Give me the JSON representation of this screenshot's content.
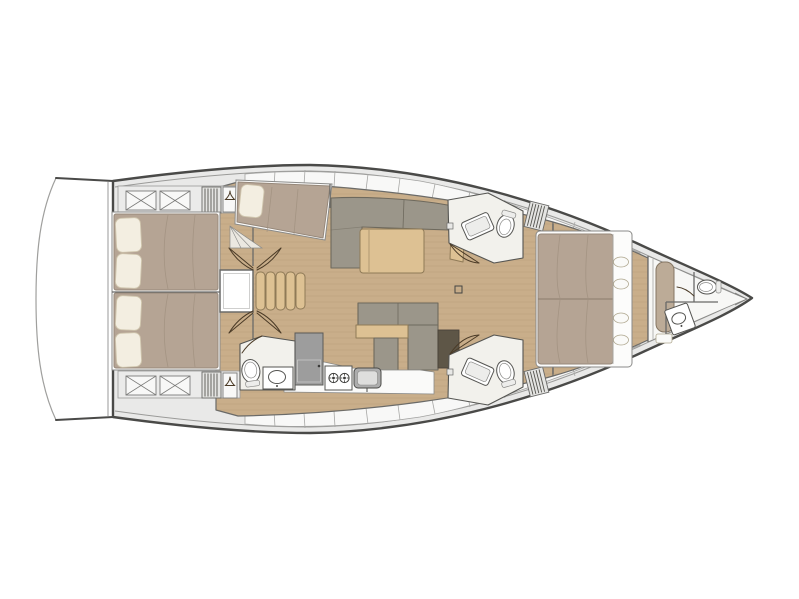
{
  "figure": {
    "type": "yacht-interior-floorplan",
    "view": "top-down",
    "bow_direction": "right"
  },
  "palette": {
    "background": "#ffffff",
    "hull_outline": "#4a4a48",
    "deck": "#e9e9e8",
    "deck_panel": "#f8f8f7",
    "wood_floor": "#c9ae8a",
    "wood_grain": "#a98e69",
    "bath_floor": "#f2f1ec",
    "bed_duvet": "#b5a494",
    "bed_base": "#fcfcfb",
    "pillow": "#f3eee1",
    "sofa": "#9b968a",
    "table_wood": "#ddc193",
    "dark_panel": "#5e5647",
    "appliance": "#9d9d9d",
    "steel": "#adadad",
    "fixture": "#ffffff",
    "fixture_line": "#555552",
    "door_line": "#4a3a26",
    "bench": "#bcab97",
    "wall_line": "#6a6a68"
  },
  "areas": [
    {
      "id": "swim-platform",
      "label": "swim-platform"
    },
    {
      "id": "aft-cabin-port",
      "label": "aft-cabin-port",
      "fixtures": [
        "double-bed",
        "pillows",
        "stowage-x-boxes",
        "vent-grate",
        "wardrobe-hanger"
      ]
    },
    {
      "id": "aft-cabin-starboard",
      "label": "aft-cabin-starboard",
      "fixtures": [
        "double-bed",
        "pillows",
        "stowage-x-boxes",
        "vent-grate",
        "wardrobe-hanger"
      ]
    },
    {
      "id": "companionway",
      "label": "companionway",
      "fixtures": [
        "engine-access-hatch",
        "stair-treads",
        "door-swings"
      ]
    },
    {
      "id": "mid-cabin-port",
      "label": "mid-cabin-port",
      "fixtures": [
        "angled-berth",
        "pillow",
        "step-wedge"
      ]
    },
    {
      "id": "salon",
      "label": "salon",
      "fixtures": [
        "l-shaped-sofa",
        "dining-table",
        "side-cabinet"
      ]
    },
    {
      "id": "nav-seating",
      "label": "nav-seating",
      "fixtures": [
        "l-shaped-seat",
        "wood-ledge",
        "dark-panel"
      ]
    },
    {
      "id": "galley",
      "label": "galley",
      "fixtures": [
        "refrigerator",
        "two-burner-stove",
        "sink",
        "counter"
      ]
    },
    {
      "id": "aft-head",
      "label": "aft-head",
      "fixtures": [
        "toilet",
        "washbasin",
        "door-swing"
      ]
    },
    {
      "id": "head-forward-port",
      "label": "head-forward-port",
      "fixtures": [
        "washbasin",
        "toilet",
        "shower-grate",
        "door-swing"
      ]
    },
    {
      "id": "head-forward-starboard",
      "label": "head-forward-starboard",
      "fixtures": [
        "washbasin",
        "toilet",
        "shower-grate",
        "door-swing"
      ]
    },
    {
      "id": "owner-cabin",
      "label": "owner-cabin",
      "fixtures": [
        "island-double-bed",
        "headboard-shelf-cushions"
      ]
    },
    {
      "id": "forepeak",
      "label": "forepeak",
      "fixtures": [
        "bench-seat",
        "toilet",
        "washbasin",
        "bow-locker"
      ]
    }
  ]
}
